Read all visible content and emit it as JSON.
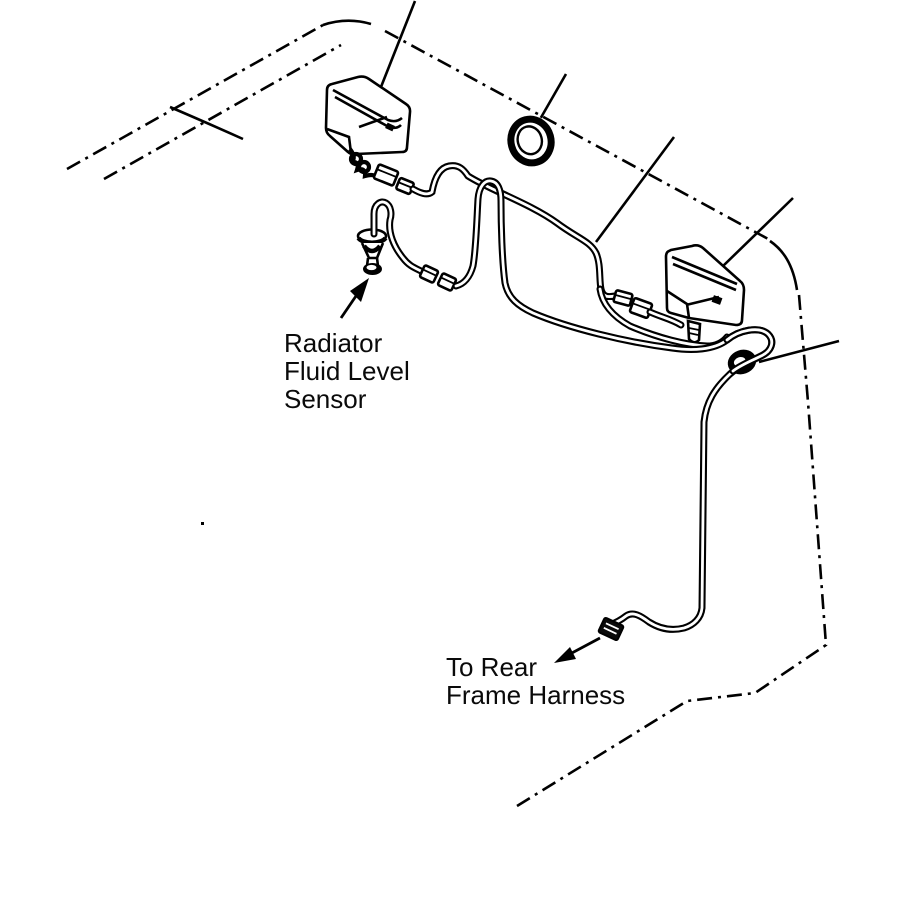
{
  "diagram": {
    "labels": {
      "radiator_sensor": {
        "line1": "Radiator",
        "line2": "Fluid Level",
        "line3": "Sensor"
      },
      "rear_harness": {
        "line1": "To Rear",
        "line2": "Frame Harness"
      }
    },
    "colors": {
      "ink": "#000000",
      "background": "#ffffff"
    }
  }
}
